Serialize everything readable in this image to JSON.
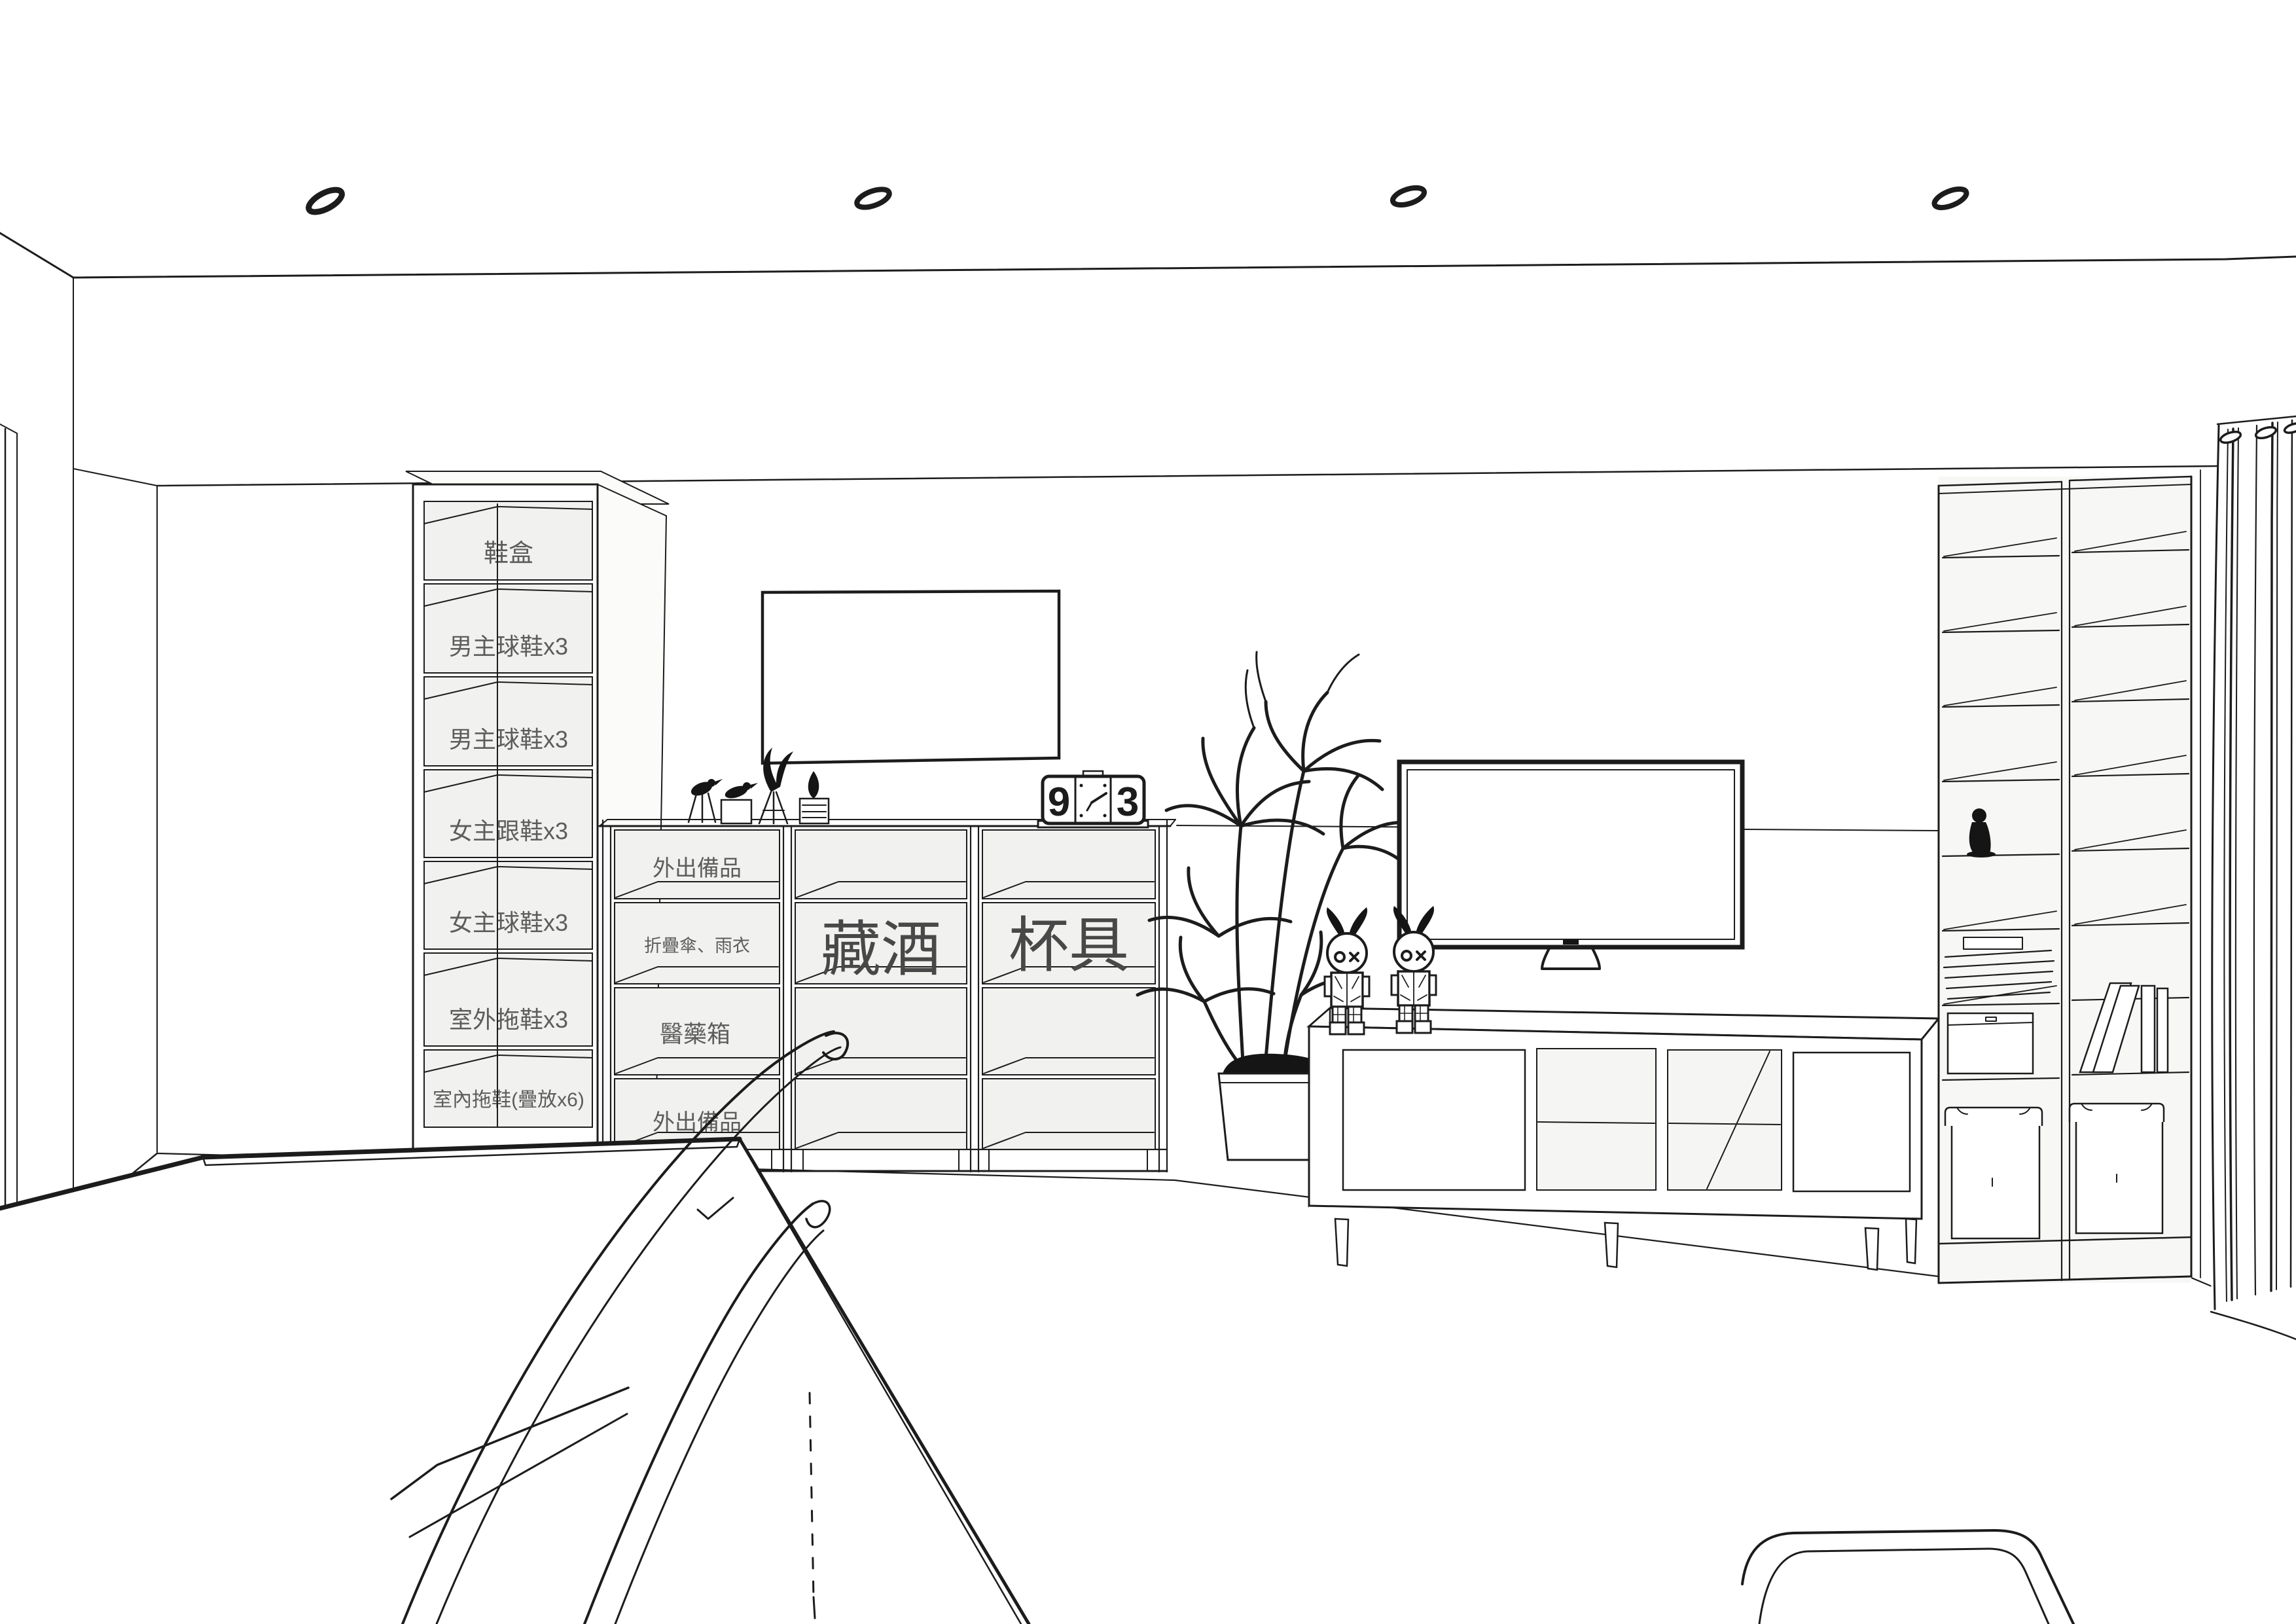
{
  "meta": {
    "type": "interior-design-line-rendering",
    "view": "living room entry wall with labeled storage"
  },
  "colors": {
    "line": "#1c1c1c",
    "wall": "#ffffff",
    "cell_gray": "#efefec",
    "green": "#dce8db",
    "tan": "#f3e7d4",
    "label": "#5d5d5d",
    "label_dark": "#484848"
  },
  "shoe_cabinet": {
    "name": "tall entry shoe cabinet",
    "rows": [
      {
        "label": "鞋盒",
        "tint": "gray"
      },
      {
        "label": "男主球鞋x3",
        "tint": "green"
      },
      {
        "label": "男主球鞋x3",
        "tint": "green"
      },
      {
        "label": "女主跟鞋x3",
        "tint": "tan"
      },
      {
        "label": "女主球鞋x3",
        "tint": "tan"
      },
      {
        "label": "室外拖鞋x3",
        "tint": "gray"
      },
      {
        "label": "室內拖鞋(疊放x6)",
        "tint": "gray"
      }
    ]
  },
  "sideboard": {
    "name": "three-bay open sideboard",
    "unit1_rows": [
      {
        "label": "外出備品"
      },
      {
        "label": "折疊傘、雨衣"
      },
      {
        "label": "醫藥箱"
      },
      {
        "label": "外出備品"
      }
    ],
    "unit2": {
      "label": "藏酒"
    },
    "unit3": {
      "label": "杯具"
    }
  },
  "clock": {
    "left_digit": "9",
    "right_digit": "3",
    "style": "flip clock with analog center dial"
  },
  "decor": {
    "items": [
      "recessed-ceiling-light x4",
      "bird-figurine-on-tripod",
      "bird-figurine-on-block",
      "sprig-ornament-on-stand",
      "leaf-ornament-on-stand",
      "flip-clock",
      "blank-picture-frame",
      "potted-yucca-plant",
      "art-toy-figurine x2",
      "wall-mounted-tv",
      "mini-figure",
      "leaning-books",
      "folded-linens",
      "flat-box",
      "storage-box-with-lid x2",
      "eyelet-curtain",
      "wireframe-dining-table",
      "wireframe-chair"
    ]
  }
}
